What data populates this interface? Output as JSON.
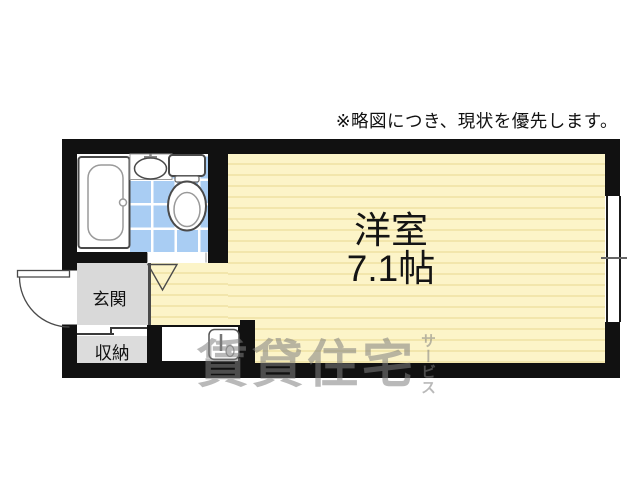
{
  "disclaimer": "※略図につき、現状を優先します。",
  "plan": {
    "main_room": {
      "name": "洋室",
      "area": "7.1帖"
    },
    "entrance": {
      "label": "玄関"
    },
    "storage": {
      "label": "収納"
    }
  },
  "watermark": {
    "main": "賃貸住宅",
    "vertical": "サービス"
  },
  "fixtures": [
    "bathtub",
    "washbasin",
    "toilet",
    "bathroom-door-triangle",
    "entrance-door-swing",
    "kitchen-sink",
    "window",
    "sliding-closet-door"
  ],
  "colors": {
    "wall": "#111111",
    "room-fill": "#fcf4c8",
    "room-stripe": "#f2e6ac",
    "tile-fill": "#a9cdf3",
    "tile-grid": "#ffffff",
    "entrance-fill": "#d9d9d9",
    "storage-fill": "#dcdcdc",
    "counter-fill": "#ffffff",
    "watermark": "rgba(128,128,128,0.55)",
    "text": "#111111",
    "fixture-stroke": "#4a4a4a"
  }
}
